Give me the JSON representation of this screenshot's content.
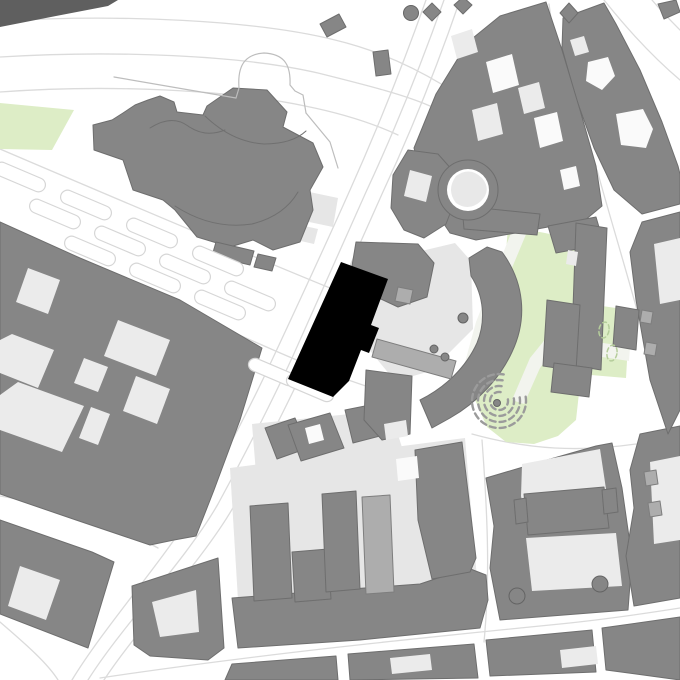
{
  "map": {
    "width": 680,
    "height": 680,
    "colors": {
      "background": "#ffffff",
      "building_gray": "#868686",
      "building_stroke": "#6e6e6e",
      "courtyard_light": "#ebebeb",
      "courtyard_white": "#fafafa",
      "plaza_light": "#e6e6e6",
      "green": "#ddedc6",
      "green_path": "#f2f4ee",
      "medium_gray": "#adadad",
      "street_line": "#dbdbdb",
      "dark_edge_strip": "#5f5f5f",
      "project_black": "#000000",
      "amphitheater_stroke": "#9b9b9b",
      "tree_stroke": "#b5cd9b"
    },
    "layers": [
      {
        "n": "street-lines",
        "t": "paths",
        "f": "none",
        "s": "#dbdbdb",
        "w": 1.3,
        "d": [
          "M0,21 C120,14 255,20 335,40 C410,58 475,100 530,152 C560,180 585,215 600,244",
          "M0,57 C115,50 240,55 318,73 C370,86 405,95 430,106",
          "M0,92 C110,84 230,90 305,106 C340,113 370,122 398,135",
          "M0,149 C110,196 220,243 330,288",
          "M0,233 C90,271 180,309 262,345",
          "M262,345 C300,362 340,378 378,390",
          "M426,0 C404,62 376,132 350,190 C326,244 300,300 272,360 C248,412 226,452 200,500 C168,556 106,624 72,680",
          "M444,0 C422,62 394,132 366,192 C342,246 318,300 292,358 C268,410 244,456 218,504 C186,560 122,626 88,680",
          "M460,0 C438,64 410,134 382,194 C358,248 334,302 308,360 C284,412 260,458 234,506 C202,562 138,628 104,680",
          "M549,4 C556,60 572,118 593,172",
          "M604,0 C628,30 654,58 680,80",
          "M652,0 C662,12 672,22 680,30",
          "M597,170 C615,235 636,302 652,366 C658,390 665,420 670,446",
          "M0,496 C60,506 112,522 158,548",
          "M0,622 C28,646 48,664 58,680",
          "M100,678 C260,654 420,638 560,624 C600,620 642,614 680,608",
          "M472,434 C530,450 580,452 636,444",
          "M482,440 C488,520 490,580 484,642"
        ]
      },
      {
        "n": "green-areas",
        "t": "paths",
        "f": "#ddedc6",
        "s": "none",
        "d": [
          "M0,103 L74,110 L52,150 L0,149 Z",
          "M508,226 L545,233 L578,240 L600,254 L597,300 L588,342 L580,384 L576,420 L558,436 L534,444 L506,442 L487,427 L475,400 L479,372 L493,338 L502,306 Z",
          "M560,300 L630,310 L626,378 L556,372 Z"
        ]
      },
      {
        "n": "green-path-stripes",
        "t": "paths",
        "f": "#f2f4ee",
        "s": "none",
        "d": [
          "M513,228 L527,232 L486,330 L470,392 L458,388 L476,322 Z",
          "M600,268 L600,288 L540,368 L524,404 L512,400 L530,358 L585,290 Z",
          "M556,336 L630,347 L629,361 L555,350 Z"
        ]
      },
      {
        "n": "light-plazas",
        "t": "paths",
        "f": "#e6e6e6",
        "s": "none",
        "d": [
          "M350,268 L455,243 L471,261 L473,329 L431,371 L395,381 L367,347 L355,300 Z",
          "M230,468 L465,438 L478,590 L238,600 Z",
          "M252,424 L390,410 L408,466 L386,490 L258,498 Z",
          "M300,190 L338,198 L333,227 L295,219 Z",
          "M296,224 L318,229 L314,244 L292,239 Z"
        ]
      },
      {
        "n": "buildings",
        "t": "paths",
        "f": "#868686",
        "s": "#6e6e6e",
        "w": 1,
        "d": [
          "M148,100 L160,96 L174,102 L177,112 L203,115 L207,106 L233,88 L267,90 L287,112 L283,127 L313,143 L323,167 L310,190 L313,210 L300,242 L273,250 L253,240 L230,247 L197,237 L175,210 L163,200 L133,190 L123,160 L94,150 L93,125 L112,120 L123,113 L135,105 Z",
          "M216,242 L254,251 L250,265 L212,256 Z",
          "M258,254 L276,258 L272,271 L254,267 Z",
          "M0,222 L80,258 L180,300 L262,348 L240,420 L214,490 L196,536 L174,540 L150,545 L76,520 L0,494 Z",
          "M0,520 L92,552 L114,562 L88,648 L0,614 Z",
          "M132,586 L218,558 L224,648 L208,660 L150,656 L134,645 Z",
          "M232,598 L310,592 L420,584 L468,568 L486,575 L488,600 L480,628 L360,640 L238,648 Z",
          "M415,450 L462,442 L476,558 L470,572 L432,579 L418,520 Z",
          "M250,506 L288,503 L292,598 L254,601 Z",
          "M292,552 L328,549 L331,599 L295,602 Z",
          "M322,494 L356,491 L360,589 L326,592 Z",
          "M486,478 L540,462 L596,446 L612,443 L622,488 L632,558 L628,610 L500,620 L490,568 L494,526 Z",
          "M640,434 L680,426 L680,598 L634,606 L626,556 L634,508 L630,470 Z",
          "M642,222 L680,212 L680,410 L668,434 L650,380 L636,300 L630,252 Z",
          "M563,18 L604,3 L616,24 L640,70 L662,122 L678,166 L680,174 L680,204 L642,214 L614,190 L594,148 L576,98 L562,48 Z",
          "M436,94 L468,42 L500,16 L546,2 L562,50 L580,110 L596,166 L602,206 L584,221 L548,227 L510,234 L476,240 L450,233 L432,206 L420,170 L414,148 Z",
          "M408,150 L438,154 L454,172 L456,198 L446,224 L424,238 L404,230 L391,208 L393,175 Z",
          "M502,252 C524,282 528,318 512,352 C500,378 478,402 450,418 L432,428 L420,400 C446,387 466,367 477,343 C486,321 484,296 471,276 L469,258 L487,247 Z",
          "M356,242 L418,244 L434,263 L427,297 L398,307 L368,293 L352,266 Z",
          "M548,226 L596,217 L604,244 L556,253 Z",
          "M462,206 L540,214 L537,235 L464,229 Z",
          "M576,223 L607,228 L601,370 L571,365 Z",
          "M225,680 L232,664 L336,656 L338,680 Z",
          "M350,680 L348,654 L474,644 L478,678 Z",
          "M490,676 L486,640 L592,630 L596,672 Z",
          "M606,670 L602,628 L680,617 L680,680 Z",
          "M265,428 L295,418 L308,448 L277,459 Z",
          "M288,425 L330,413 L344,448 L301,461 Z",
          "M345,410 L375,404 L384,435 L353,443 Z",
          "M366,370 L412,376 L410,434 L382,440 L364,420 Z",
          "M320,24 L339,14 L346,27 L327,37 Z",
          "M373,52 L388,50 L391,74 L376,76 Z",
          "M432,3 L441,12 L432,21 L423,12 Z",
          "M463,-3 L472,5 L463,14 L454,5 Z",
          "M569,3 L578,13 L569,23 L560,13 Z",
          "M658,4 L676,0 L680,12 L664,19 Z"
        ]
      },
      {
        "n": "building-courtyards-light",
        "t": "paths",
        "f": "#ebebeb",
        "s": "none",
        "d": [
          "M28,268 L60,280 L48,314 L16,302 Z",
          "M118,320 L170,340 L156,376 L104,356 Z",
          "M12,334 L54,350 L38,388 L0,373 L0,340 Z",
          "M84,358 L108,367 L98,392 L74,383 Z",
          "M136,376 L170,389 L157,424 L123,411 Z",
          "M18,382 L84,406 L62,452 L0,430 L0,395 Z",
          "M91,407 L110,414 L98,445 L79,438 Z",
          "M518,88 L539,82 L545,108 L524,114 Z",
          "M472,110 L497,103 L503,134 L478,141 Z",
          "M451,36 L472,29 L478,52 L457,59 Z",
          "M410,170 L432,176 L426,202 L404,196 Z",
          "M522,464 L600,449 L606,489 L598,526 L528,531 L521,496 Z",
          "M526,538 L616,533 L622,586 L532,591 Z",
          "M650,462 L680,456 L680,540 L654,544 Z",
          "M654,244 L680,238 L680,300 L660,304 Z",
          "M570,40 L584,36 L589,52 L575,56 Z",
          "M152,602 L196,590 L199,632 L160,637 Z",
          "M20,566 L60,580 L46,620 L8,606 Z",
          "M390,658 L430,654 L432,670 L392,674 Z",
          "M560,650 L596,646 L598,664 L562,668 Z",
          "M568,250 L578,252 L576,266 L566,264 Z",
          "M564,340 L574,342 L572,356 L562,354 Z",
          "M384,424 L406,420 L408,436 L386,440 Z"
        ]
      },
      {
        "n": "building-courtyards-white",
        "t": "paths",
        "f": "#fafafa",
        "s": "none",
        "d": [
          "M486,62 L512,54 L519,85 L493,93 Z",
          "M534,118 L557,112 L563,141 L540,148 Z",
          "M560,170 L576,166 L580,186 L564,190 Z",
          "M588,62 L608,57 L615,76 L602,90 L586,81 Z",
          "M616,114 L643,109 L653,129 L646,148 L621,145 Z",
          "M396,459 L417,456 L419,478 L398,481 Z",
          "M305,428 L320,424 L324,440 L309,444 Z"
        ]
      },
      {
        "n": "buildings-over",
        "t": "paths",
        "f": "#868686",
        "s": "#6e6e6e",
        "w": 1,
        "d": [
          "M524,494 L604,487 L609,528 L528,535 Z",
          "M514,500 L526,498 L528,522 L516,524 Z",
          "M602,490 L616,488 L618,512 L604,514 Z",
          "M547,300 L580,305 L576,371 L543,366 Z",
          "M554,363 L592,368 L589,397 L551,392 Z",
          "M616,306 L639,310 L636,350 L613,346 Z"
        ]
      },
      {
        "n": "medium-structures",
        "t": "paths",
        "f": "#adadad",
        "s": "#7e7e7e",
        "w": 1,
        "d": [
          "M362,497 L390,495 L394,592 L366,594 Z",
          "M377,339 L456,361 L451,379 L372,357 Z",
          "M398,287 L413,290 L410,304 L395,301 Z",
          "M642,310 L653,312 L651,324 L640,322 Z",
          "M646,342 L657,344 L655,356 L644,354 Z",
          "M644,472 L656,470 L658,484 L646,486 Z",
          "M648,503 L660,501 L662,515 L650,517 Z"
        ]
      },
      {
        "n": "rotunda-ring",
        "t": "circles",
        "f": "#868686",
        "s": "#6e6e6e",
        "w": 1,
        "it": [
          {
            "cx": 468,
            "cy": 190,
            "r": 30
          }
        ]
      },
      {
        "n": "rotunda-courtyard",
        "t": "circles",
        "f": "#ffffff",
        "s": "none",
        "it": [
          {
            "cx": 468,
            "cy": 190,
            "r": 21
          }
        ]
      },
      {
        "n": "rotunda-lobe",
        "t": "paths",
        "f": "#e8e8e8",
        "s": "none",
        "d": [
          "M456,176 Q470,166 482,178 Q492,190 481,201 Q469,212 456,203 Q446,190 456,176 Z"
        ]
      },
      {
        "n": "parking-strips",
        "t": "rects",
        "f": "#ffffff",
        "s": "#d6d6d6",
        "w": 1.2,
        "rx": 7,
        "it": [
          {
            "cx": 20,
            "cy": 177,
            "w": 54,
            "h": 14,
            "a": 23
          },
          {
            "cx": 86,
            "cy": 205,
            "w": 54,
            "h": 14,
            "a": 23
          },
          {
            "cx": 152,
            "cy": 233,
            "w": 54,
            "h": 14,
            "a": 23
          },
          {
            "cx": 218,
            "cy": 261,
            "w": 54,
            "h": 14,
            "a": 23
          },
          {
            "cx": 55,
            "cy": 214,
            "w": 54,
            "h": 14,
            "a": 23
          },
          {
            "cx": 120,
            "cy": 241,
            "w": 54,
            "h": 14,
            "a": 23
          },
          {
            "cx": 185,
            "cy": 269,
            "w": 54,
            "h": 14,
            "a": 23
          },
          {
            "cx": 250,
            "cy": 296,
            "w": 54,
            "h": 14,
            "a": 23
          },
          {
            "cx": 90,
            "cy": 251,
            "w": 54,
            "h": 14,
            "a": 23
          },
          {
            "cx": 155,
            "cy": 278,
            "w": 54,
            "h": 14,
            "a": 23
          },
          {
            "cx": 220,
            "cy": 305,
            "w": 54,
            "h": 14,
            "a": 23
          },
          {
            "cx": 272,
            "cy": 372,
            "w": 50,
            "h": 13,
            "a": 23
          },
          {
            "cx": 310,
            "cy": 388,
            "w": 50,
            "h": 13,
            "a": 23
          }
        ]
      },
      {
        "n": "amphitheater-arcs",
        "t": "paths",
        "f": "none",
        "s": "#9b9b9b",
        "w": 2.4,
        "dash": "6 4",
        "d": [
          "M500.6,392.1 A9,9 0 1 0 507.9,399.4",
          "M501.6,386.2 A15,15 0 1 0 513.8,398.4",
          "M502.6,380.3 A21,21 0 1 0 519.7,397.4",
          "M503.7,374.4 A27,27 0 1 0 525.6,396.3"
        ]
      },
      {
        "n": "tower-circles",
        "t": "circles",
        "f": "#868686",
        "s": "#646464",
        "w": 1,
        "it": [
          {
            "cx": 517,
            "cy": 596,
            "r": 8
          },
          {
            "cx": 600,
            "cy": 584,
            "r": 8
          },
          {
            "cx": 463,
            "cy": 318,
            "r": 5
          },
          {
            "cx": 434,
            "cy": 349,
            "r": 4
          },
          {
            "cx": 445,
            "cy": 357,
            "r": 4
          },
          {
            "cx": 411,
            "cy": 13,
            "r": 7.5
          },
          {
            "cx": 497,
            "cy": 403,
            "r": 3.5
          }
        ]
      },
      {
        "n": "tree-ovals",
        "t": "ellipses",
        "f": "none",
        "s": "#b5cd9b",
        "w": 1.5,
        "dash": "4 3",
        "it": [
          {
            "cx": 604,
            "cy": 330,
            "rx": 5,
            "ry": 8,
            "a": 10
          },
          {
            "cx": 612,
            "cy": 353,
            "rx": 5,
            "ry": 8,
            "a": 10
          }
        ]
      },
      {
        "n": "outline-decor",
        "t": "paths",
        "f": "none",
        "s": "#bdbdbd",
        "w": 1.2,
        "d": [
          "M236,98 L239,88 C237,62 248,54 264,53 C282,54 291,62 290,85 L295,91 L303,95 L306,113",
          "M114,77 L236,98",
          "M306,113 L330,142 L338,168"
        ]
      },
      {
        "n": "church-inner-lines",
        "t": "paths",
        "f": "none",
        "s": "#707070",
        "w": 1,
        "d": [
          "M150,128 Q172,114 188,126 Q205,138 225,130",
          "M175,206 Q212,230 252,224 Q284,216 298,192",
          "M205,116 Q232,142 264,144 Q292,144 306,131"
        ]
      },
      {
        "n": "edge-strip-dark",
        "t": "paths",
        "f": "#5f5f5f",
        "s": "none",
        "d": [
          "M0,0 L118,0 L108,6 L56,16 L0,27 Z"
        ]
      },
      {
        "n": "project-building-black",
        "t": "paths",
        "f": "#000000",
        "s": "none",
        "d": [
          "M341,262 L388,279 L371,325 L379,328 L369,353 L361,350 L349,381 L333,397 L288,379 Z"
        ]
      }
    ]
  }
}
